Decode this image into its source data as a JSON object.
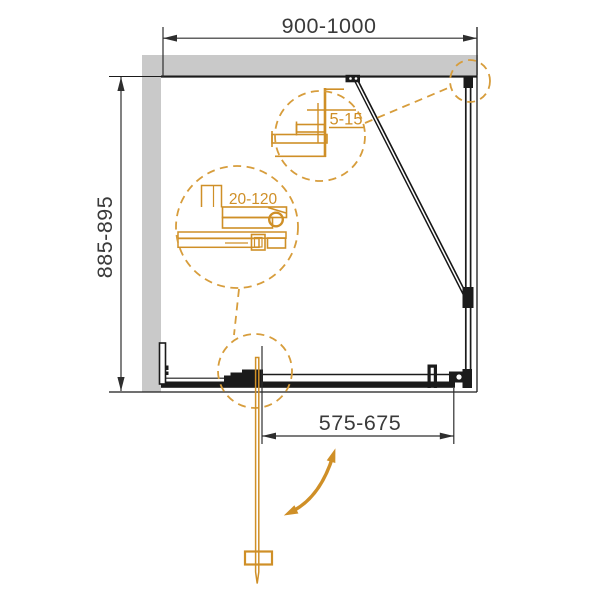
{
  "drawing": {
    "type": "shower-enclosure-top-view-technical-drawing",
    "dimensions": {
      "width": "900-1000",
      "depth": "885-895",
      "door_opening": "575-675",
      "top_detail": "5-15",
      "middle_detail": "20-120"
    },
    "colors": {
      "accent_orange": "#cf8f27",
      "dashed_circle_orange": "#d79d3c",
      "wall_gray": "#c9c9c9",
      "line_black": "#1b1b1b",
      "dimension_text": "#3a3a3a",
      "background": "#ffffff"
    }
  }
}
